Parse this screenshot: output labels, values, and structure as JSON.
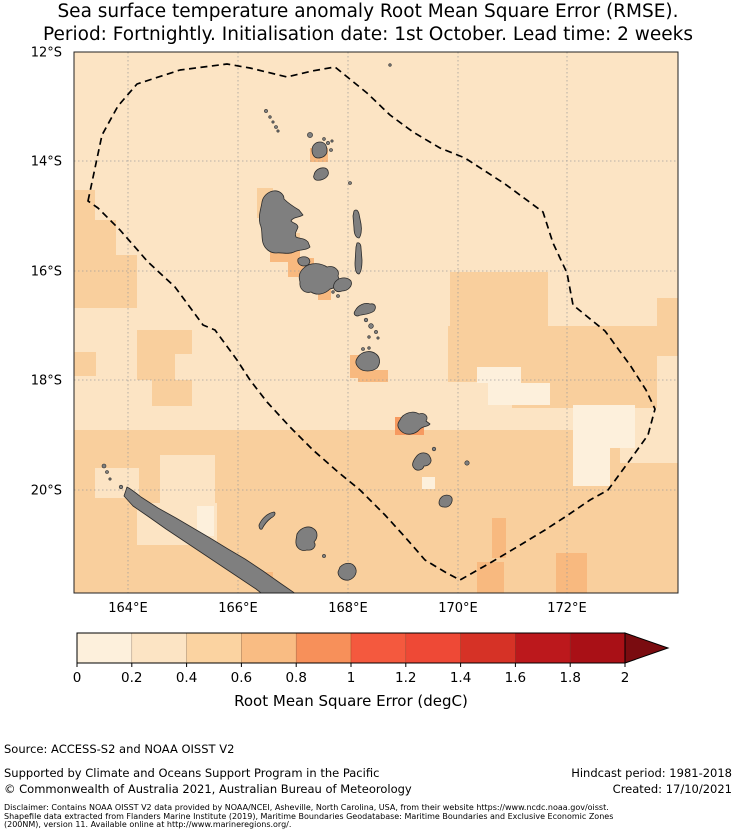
{
  "title": {
    "line1": "Sea surface temperature anomaly Root Mean Square Error (RMSE).",
    "line2": "Period: Fortnightly. Initialisation date: 1st October. Lead time: 2 weeks"
  },
  "chart_data": {
    "type": "heatmap",
    "subtype": "geographic-map-rmse-grid",
    "title": "Sea surface temperature anomaly Root Mean Square Error (RMSE). Period: Fortnightly. Initialisation date: 1st October. Lead time: 2 weeks",
    "x_axis": {
      "tick_labels": [
        "164°E",
        "166°E",
        "168°E",
        "170°E",
        "172°E"
      ],
      "tick_x_px": [
        128,
        238,
        348,
        458,
        567
      ],
      "range_lon": [
        163.0,
        174.0
      ]
    },
    "y_axis": {
      "tick_labels": [
        "12°S",
        "14°S",
        "16°S",
        "18°S",
        "20°S"
      ],
      "tick_y_px": [
        52,
        161,
        271,
        380,
        490
      ],
      "range_lat": [
        -12.0,
        -21.9
      ]
    },
    "colorbar": {
      "label": "Root Mean Square Error (degC)",
      "tick_labels": [
        "0",
        "0.2",
        "0.4",
        "0.6",
        "0.8",
        "1",
        "1.2",
        "1.4",
        "1.6",
        "1.8",
        "2"
      ],
      "range": [
        0,
        2
      ],
      "segment_colors": [
        "#fdf0dc",
        "#fce4c4",
        "#fbd3a1",
        "#f9bc83",
        "#f7905a",
        "#f4593e",
        "#ee4936",
        "#d63226",
        "#bc181c",
        "#a91016"
      ],
      "arrow_color": "#7a0c10",
      "bar_x": [
        77,
        625
      ],
      "bar_y": [
        633,
        663
      ],
      "arrow_tip_x": 668,
      "tick_label_baseline_y": 682,
      "label_baseline_y": 706
    },
    "map_frame": {
      "x": 74,
      "y": 52,
      "w": 604,
      "h": 541
    },
    "base_band": {
      "band": "0.2-0.4",
      "color": "#fce4c4"
    },
    "land_color": "#7f7f7f",
    "land_stroke": "#2b2b2b",
    "grid_color": "#999999",
    "eez_style": {
      "stroke": "#000000",
      "dash": "7 4.5",
      "width": 1.7
    },
    "cells": [
      {
        "x": 74,
        "y": 430,
        "w": 604,
        "h": 163,
        "band": "0.4-0.6",
        "color": "#f9cf9d"
      },
      {
        "x": 74,
        "y": 190,
        "w": 21,
        "h": 30,
        "band": "0.4-0.6",
        "color": "#f9cf9d"
      },
      {
        "x": 74,
        "y": 220,
        "w": 42,
        "h": 35,
        "band": "0.4-0.6",
        "color": "#f9cf9d"
      },
      {
        "x": 74,
        "y": 255,
        "w": 63,
        "h": 53,
        "band": "0.4-0.6",
        "color": "#f9cf9d"
      },
      {
        "x": 74,
        "y": 352,
        "w": 22,
        "h": 24,
        "band": "0.4-0.6",
        "color": "#f9cf9d"
      },
      {
        "x": 137,
        "y": 330,
        "w": 55,
        "h": 24,
        "band": "0.4-0.6",
        "color": "#f9cf9d"
      },
      {
        "x": 137,
        "y": 354,
        "w": 38,
        "h": 26,
        "band": "0.4-0.6",
        "color": "#f9cf9d"
      },
      {
        "x": 152,
        "y": 380,
        "w": 40,
        "h": 26,
        "band": "0.4-0.6",
        "color": "#f9cf9d"
      },
      {
        "x": 257,
        "y": 188,
        "w": 16,
        "h": 30,
        "band": "0.4-0.6",
        "color": "#f9cf9d"
      },
      {
        "x": 270,
        "y": 233,
        "w": 30,
        "h": 12,
        "band": "0.4-0.6",
        "color": "#f9cf9d"
      },
      {
        "x": 450,
        "y": 272,
        "w": 98,
        "h": 54,
        "band": "0.4-0.6",
        "color": "#f9cf9d"
      },
      {
        "x": 448,
        "y": 326,
        "w": 64,
        "h": 56,
        "band": "0.4-0.6",
        "color": "#f9cf9d"
      },
      {
        "x": 512,
        "y": 326,
        "w": 169,
        "h": 30,
        "band": "0.4-0.6",
        "color": "#f9cf9d"
      },
      {
        "x": 512,
        "y": 356,
        "w": 145,
        "h": 52,
        "band": "0.4-0.6",
        "color": "#f9cf9d"
      },
      {
        "x": 657,
        "y": 298,
        "w": 24,
        "h": 30,
        "band": "0.4-0.6",
        "color": "#f9cf9d"
      },
      {
        "x": 95,
        "y": 468,
        "w": 44,
        "h": 30,
        "band": "0.2-0.4",
        "color": "#fce4c4"
      },
      {
        "x": 160,
        "y": 455,
        "w": 55,
        "h": 48,
        "band": "0.2-0.4",
        "color": "#fce4c4"
      },
      {
        "x": 137,
        "y": 503,
        "w": 80,
        "h": 42,
        "band": "0.2-0.4",
        "color": "#fce4c4"
      },
      {
        "x": 620,
        "y": 430,
        "w": 58,
        "h": 33,
        "band": "0.2-0.4",
        "color": "#fce4c4"
      },
      {
        "x": 477,
        "y": 367,
        "w": 44,
        "h": 16,
        "band": "0-0.2",
        "color": "#fdf0dc"
      },
      {
        "x": 488,
        "y": 383,
        "w": 62,
        "h": 22,
        "band": "0-0.2",
        "color": "#fdf0dc"
      },
      {
        "x": 573,
        "y": 405,
        "w": 62,
        "h": 43,
        "band": "0-0.2",
        "color": "#fdf0dc"
      },
      {
        "x": 573,
        "y": 448,
        "w": 37,
        "h": 38,
        "band": "0-0.2",
        "color": "#fdf0dc"
      },
      {
        "x": 422,
        "y": 477,
        "w": 13,
        "h": 12,
        "band": "0-0.2",
        "color": "#fdf0dc"
      },
      {
        "x": 197,
        "y": 506,
        "w": 17,
        "h": 30,
        "band": "0-0.2",
        "color": "#fdf0dc"
      },
      {
        "x": 310,
        "y": 148,
        "w": 18,
        "h": 14,
        "band": "0.6-0.8",
        "color": "#f8b97f"
      },
      {
        "x": 270,
        "y": 243,
        "w": 30,
        "h": 19,
        "band": "0.6-0.8",
        "color": "#f8b97f"
      },
      {
        "x": 288,
        "y": 258,
        "w": 26,
        "h": 19,
        "band": "0.6-0.8",
        "color": "#f8b97f"
      },
      {
        "x": 318,
        "y": 285,
        "w": 13,
        "h": 15,
        "band": "0.6-0.8",
        "color": "#f8b97f"
      },
      {
        "x": 350,
        "y": 355,
        "w": 15,
        "h": 23,
        "band": "0.6-0.8",
        "color": "#f8b97f"
      },
      {
        "x": 358,
        "y": 370,
        "w": 30,
        "h": 12,
        "band": "0.6-0.8",
        "color": "#f8b97f"
      },
      {
        "x": 492,
        "y": 518,
        "w": 14,
        "h": 40,
        "band": "0.6-0.8",
        "color": "#f8b97f"
      },
      {
        "x": 477,
        "y": 562,
        "w": 27,
        "h": 33,
        "band": "0.6-0.8",
        "color": "#f8b97f"
      },
      {
        "x": 556,
        "y": 553,
        "w": 31,
        "h": 42,
        "band": "0.6-0.8",
        "color": "#f8b97f"
      },
      {
        "x": 256,
        "y": 572,
        "w": 17,
        "h": 18,
        "band": "0.6-0.8",
        "color": "#f8b97f"
      },
      {
        "x": 395,
        "y": 417,
        "w": 29,
        "h": 18,
        "band": "0.8-1.0",
        "color": "#f79a60"
      }
    ],
    "eez_points": [
      [
        88,
        201
      ],
      [
        102,
        135
      ],
      [
        118,
        106
      ],
      [
        137,
        84
      ],
      [
        180,
        70
      ],
      [
        227,
        64
      ],
      [
        250,
        68
      ],
      [
        287,
        77
      ],
      [
        312,
        71
      ],
      [
        335,
        67
      ],
      [
        367,
        93
      ],
      [
        390,
        115
      ],
      [
        413,
        132
      ],
      [
        440,
        148
      ],
      [
        465,
        158
      ],
      [
        505,
        184
      ],
      [
        543,
        212
      ],
      [
        553,
        243
      ],
      [
        567,
        273
      ],
      [
        573,
        305
      ],
      [
        605,
        331
      ],
      [
        630,
        365
      ],
      [
        646,
        390
      ],
      [
        655,
        409
      ],
      [
        648,
        435
      ],
      [
        630,
        460
      ],
      [
        608,
        490
      ],
      [
        590,
        500
      ],
      [
        568,
        515
      ],
      [
        545,
        530
      ],
      [
        517,
        547
      ],
      [
        490,
        563
      ],
      [
        460,
        580
      ],
      [
        445,
        572
      ],
      [
        425,
        560
      ],
      [
        405,
        537
      ],
      [
        385,
        515
      ],
      [
        360,
        490
      ],
      [
        338,
        472
      ],
      [
        313,
        450
      ],
      [
        290,
        427
      ],
      [
        267,
        402
      ],
      [
        250,
        380
      ],
      [
        237,
        360
      ],
      [
        215,
        330
      ],
      [
        203,
        325
      ],
      [
        175,
        287
      ],
      [
        148,
        262
      ],
      [
        120,
        230
      ],
      [
        98,
        208
      ]
    ],
    "islands": [
      {
        "name": "gaua",
        "path": "M312,150 C312,145 316,142 320,142 C325,142 327,146 327,151 C327,155 323,158 318,158 C314,158 312,154 312,150 Z"
      },
      {
        "name": "ambae",
        "path": "M314,175 C315,170 320,167 325,168 C328,169 329,172 328,175 C326,179 320,181 316,180 C314,179 313,177 314,175 Z"
      },
      {
        "name": "maewo",
        "path": "M354,211 C356,209 358,210 359,214 L361,224 C362,230 361,236 359,238 C356,238 354,234 354,228 L353,216 Z"
      },
      {
        "name": "pentecost",
        "path": "M357,243 C359,242 361,244 361,248 L362,260 C362,267 361,272 359,274 C356,274 355,270 355,263 L356,247 Z"
      },
      {
        "name": "espiritu-santo",
        "path": "M273,191 C279,190 284,194 284,199 C288,203 294,207 299,210 L303,215 C298,218 293,217 291,221 C294,224 297,223 298,227 C297,231 294,233 296,237 C300,239 305,238 308,242 L310,247 C306,251 299,249 294,252 C288,255 281,252 276,253 C270,253 265,249 263,243 C261,236 263,230 260,224 C258,216 261,209 262,202 C263,196 268,192 273,191 Z"
      },
      {
        "name": "malo",
        "path": "M298,259 C301,256 307,256 309,259 C311,262 309,266 304,266 C300,266 297,263 298,259 Z"
      },
      {
        "name": "malakula",
        "path": "M305,267 C311,262 321,263 327,267 C334,265 340,270 338,276 C341,282 336,288 330,289 C325,294 317,296 311,292 C304,294 299,288 300,282 C298,275 300,271 305,267 Z"
      },
      {
        "name": "ambrym",
        "path": "M334,284 C337,277 347,276 351,281 C353,286 348,291 342,291 C337,293 332,290 334,284 Z"
      },
      {
        "name": "epi",
        "path": "M355,311 C358,305 365,302 370,304 C375,303 377,307 374,311 C369,315 362,314 358,316 C355,316 353,314 355,311 Z"
      },
      {
        "name": "efate",
        "path": "M358,357 C362,351 371,350 376,354 C380,357 381,363 377,368 C372,372 363,372 359,368 C355,364 355,361 358,357 Z"
      },
      {
        "name": "erromango",
        "path": "M400,420 C403,413 413,410 419,414 C425,412 429,417 426,421 L430,424 C428,427 423,426 420,429 C415,435 406,436 401,431 C397,427 397,424 400,420 Z"
      },
      {
        "name": "tanna",
        "path": "M416,457 C420,451 428,452 430,457 C433,462 429,466 424,466 C423,470 417,472 414,468 C411,465 413,461 416,457 Z"
      },
      {
        "name": "aneityum",
        "path": "M440,499 C443,494 450,494 452,498 C453,503 449,508 444,507 C439,507 438,503 440,499 Z"
      },
      {
        "name": "new-caledonia-grande-terre",
        "path": "M127,487 C131,489 136,493 141,497 L158,508 L176,518 L193,528 L210,538 L228,549 L245,559 L263,571 L280,583 L296,594 L299,600 L270,600 L256,589 L238,577 L220,565 L202,553 L184,541 L166,529 L149,517 L133,506 L124,496 Z"
      },
      {
        "name": "ouvea",
        "path": "M259,525 C262,518 268,513 274,512 C276,513 275,516 271,518 C267,521 264,525 262,529 C260,530 259,528 259,525 Z"
      },
      {
        "name": "lifou",
        "path": "M297,534 C301,527 309,525 314,529 C318,532 318,538 314,542 C317,546 313,551 307,550 C300,552 295,547 296,540 Z"
      },
      {
        "name": "mare",
        "path": "M340,567 C345,562 352,562 355,567 C358,572 355,578 349,580 C343,581 338,577 338,572 Z"
      }
    ],
    "island_dots": [
      {
        "name": "hiu",
        "cx": 390,
        "cy": 65,
        "r": 1.3
      },
      {
        "name": "torres-islet",
        "cx": 266,
        "cy": 111,
        "r": 1.6
      },
      {
        "name": "torres-islet",
        "cx": 270,
        "cy": 117,
        "r": 1.3
      },
      {
        "name": "torres-islet",
        "cx": 273,
        "cy": 122,
        "r": 1.2
      },
      {
        "name": "torres-islet",
        "cx": 276,
        "cy": 127,
        "r": 1.5
      },
      {
        "name": "torres-islet",
        "cx": 278,
        "cy": 131,
        "r": 1.2
      },
      {
        "name": "mota-lava",
        "cx": 310,
        "cy": 135,
        "r": 2.6
      },
      {
        "name": "banks-islet",
        "cx": 324,
        "cy": 139,
        "r": 1.4
      },
      {
        "name": "banks-islet",
        "cx": 328,
        "cy": 143,
        "r": 1.6
      },
      {
        "name": "banks-islet",
        "cx": 332,
        "cy": 141,
        "r": 1.2
      },
      {
        "name": "mota",
        "cx": 331,
        "cy": 150,
        "r": 1.5
      },
      {
        "name": "merig-islet",
        "cx": 350,
        "cy": 183,
        "r": 1.5
      },
      {
        "name": "shepherd-islet",
        "cx": 366,
        "cy": 320,
        "r": 1.8
      },
      {
        "name": "shepherd-islet",
        "cx": 371,
        "cy": 326,
        "r": 2.4
      },
      {
        "name": "shepherd-islet",
        "cx": 376,
        "cy": 332,
        "r": 1.6
      },
      {
        "name": "shepherd-islet",
        "cx": 369,
        "cy": 337,
        "r": 1.3
      },
      {
        "name": "shepherd-islet",
        "cx": 378,
        "cy": 338,
        "r": 1.2
      },
      {
        "name": "efate-islet",
        "cx": 363,
        "cy": 349,
        "r": 1.5
      },
      {
        "name": "efate-islet",
        "cx": 369,
        "cy": 348,
        "r": 1.3
      },
      {
        "name": "malakula-islet",
        "cx": 333,
        "cy": 292,
        "r": 1.3
      },
      {
        "name": "malakula-islet",
        "cx": 338,
        "cy": 296,
        "r": 1.5
      },
      {
        "name": "aniwa",
        "cx": 434,
        "cy": 449,
        "r": 1.8
      },
      {
        "name": "futuna",
        "cx": 467,
        "cy": 463,
        "r": 2.2
      },
      {
        "name": "belep-islet",
        "cx": 104,
        "cy": 466,
        "r": 2.0
      },
      {
        "name": "belep-islet",
        "cx": 107,
        "cy": 472,
        "r": 1.5
      },
      {
        "name": "belep-islet",
        "cx": 110,
        "cy": 479,
        "r": 1.2
      },
      {
        "name": "belep-islet",
        "cx": 121,
        "cy": 487,
        "r": 1.8
      },
      {
        "name": "tiga",
        "cx": 324,
        "cy": 556,
        "r": 1.6
      }
    ]
  },
  "footer": {
    "source": "Source: ACCESS-S2 and NOAA OISST V2",
    "supported": "Supported by Climate and Oceans Support Program in the Pacific",
    "copyright": "© Commonwealth of Australia 2021, Australian Bureau of Meteorology",
    "hindcast": "Hindcast period: 1981-2018",
    "created": "Created: 17/10/2021",
    "disclaimer": {
      "line1": "Disclaimer: Contains NOAA OISST V2 data provided by NOAA/NCEI, Asheville, North Carolina, USA, from their website https://www.ncdc.noaa.gov/oisst.",
      "line2": "Shapefile data extracted from Flanders Marine Institute (2019), Maritime Boundaries Geodatabase: Maritime Boundaries and Exclusive Economic Zones",
      "line3": "(200NM), version 11. Available online at http://www.marineregions.org/."
    }
  }
}
